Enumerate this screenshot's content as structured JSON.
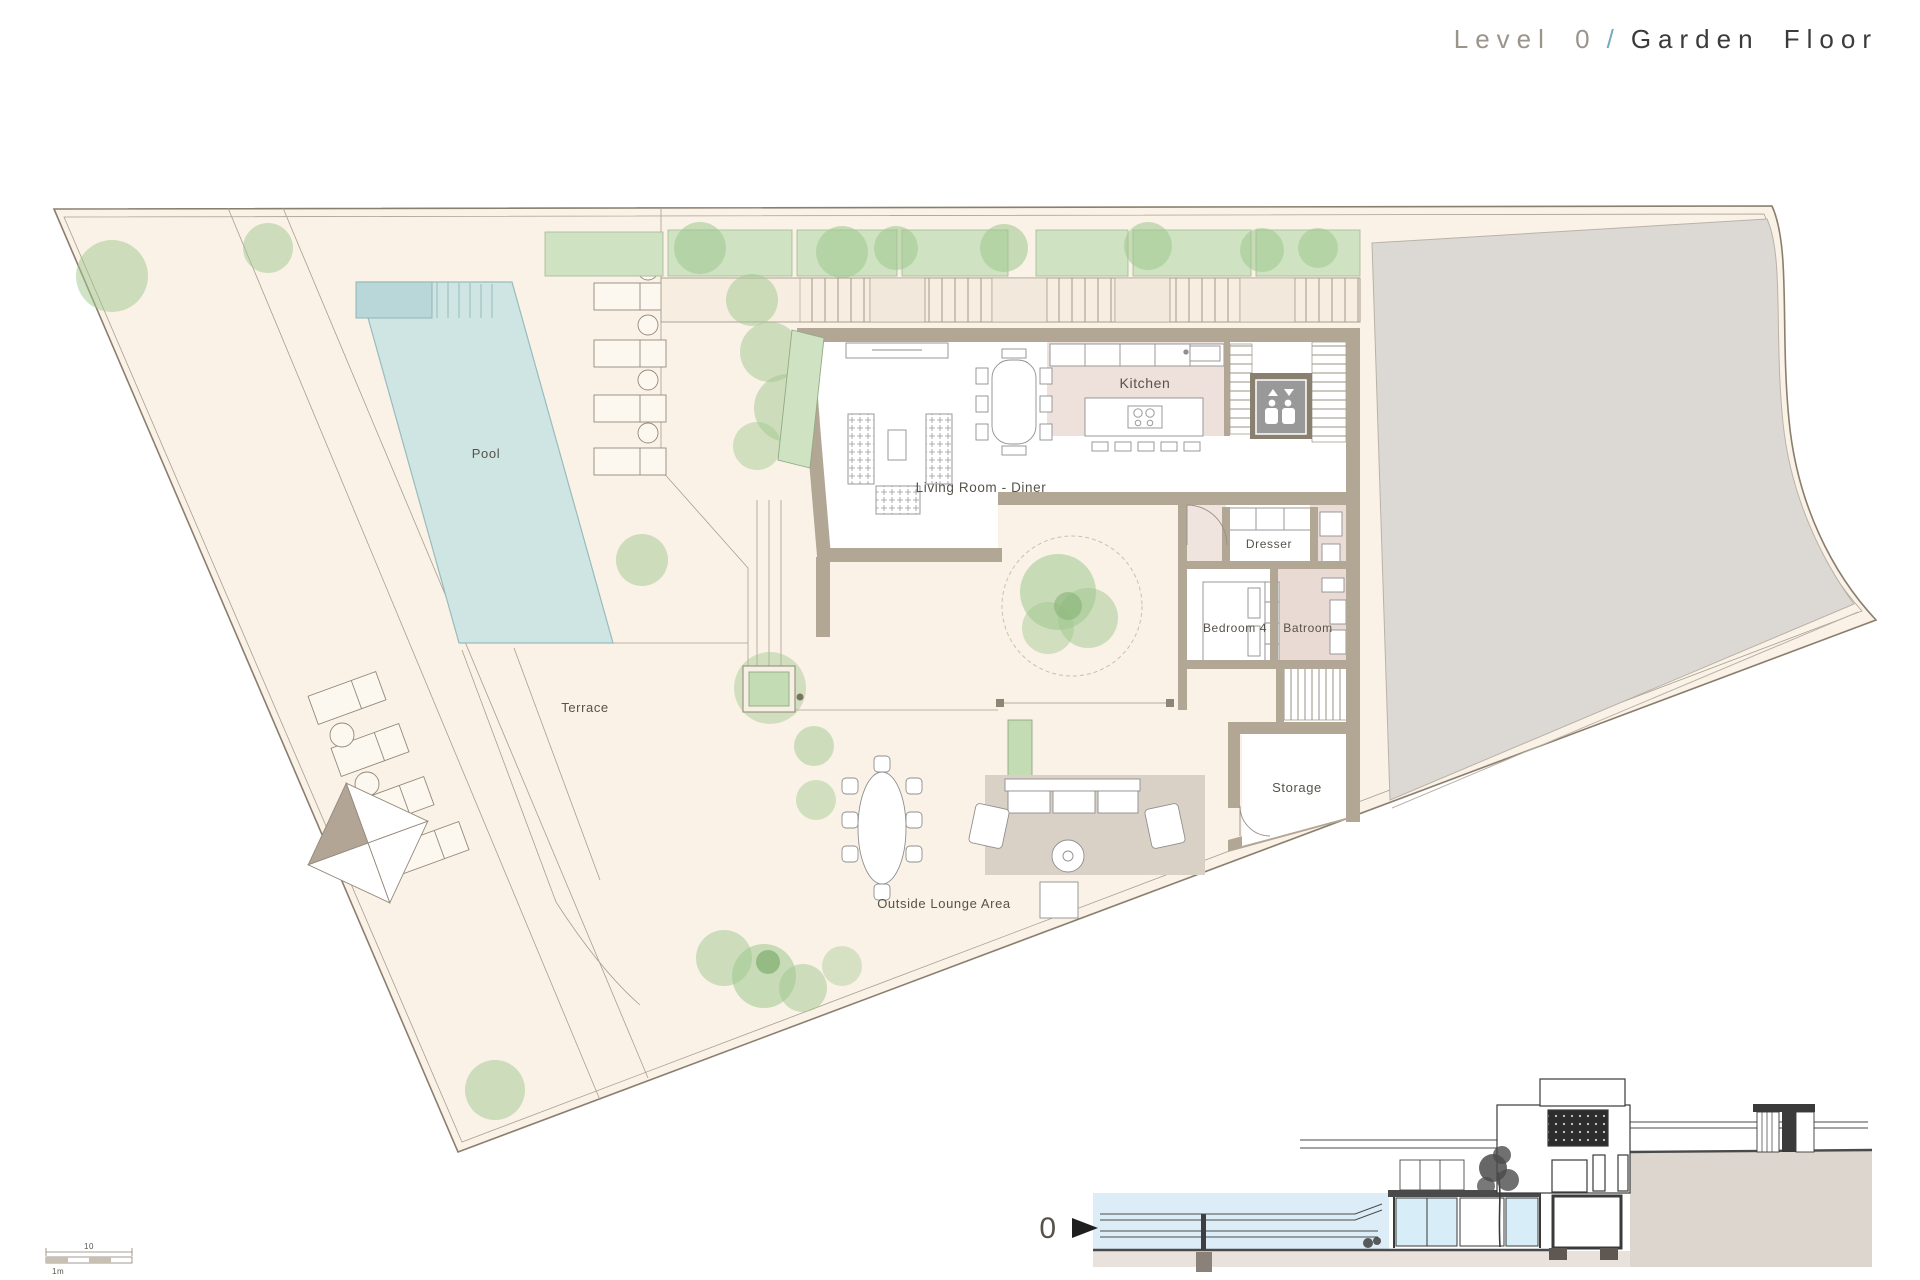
{
  "title": {
    "level": "Level 0",
    "separator": "/",
    "name": "Garden Floor"
  },
  "plan": {
    "labels": {
      "pool": "Pool",
      "terrace": "Terrace",
      "living_room": "Living Room - Diner",
      "kitchen": "Kitchen",
      "dresser": "Dresser",
      "bedroom4": "Bedroom 4",
      "bathroom": "Batroom",
      "storage": "Storage",
      "outside_lounge": "Outside Lounge Area"
    }
  },
  "section": {
    "level_marker": "0"
  },
  "scale_bar": {
    "length_label": "10",
    "unit_label": "1m"
  },
  "colors": {
    "site_fill": "#faf2e6",
    "boundary_line": "#8a7e6e",
    "pool_water": "#cfe5e3",
    "pool_spa": "#b9d7d8",
    "neighbor_gray": "#dcd9d5",
    "wall_taupe": "#b2a695",
    "kitchen_floor": "#eee0db",
    "bath_floor": "#e9dad3",
    "hedge_green": "#cfe3c3",
    "tree_green": "#9fc88f",
    "rug_taupe": "#d9d0c6",
    "section_glass": "#d7edf7",
    "section_ground": "#ddd6ce",
    "title_level": "#9b948b",
    "title_accent": "#74aabf",
    "title_name": "#3b3b3b"
  }
}
